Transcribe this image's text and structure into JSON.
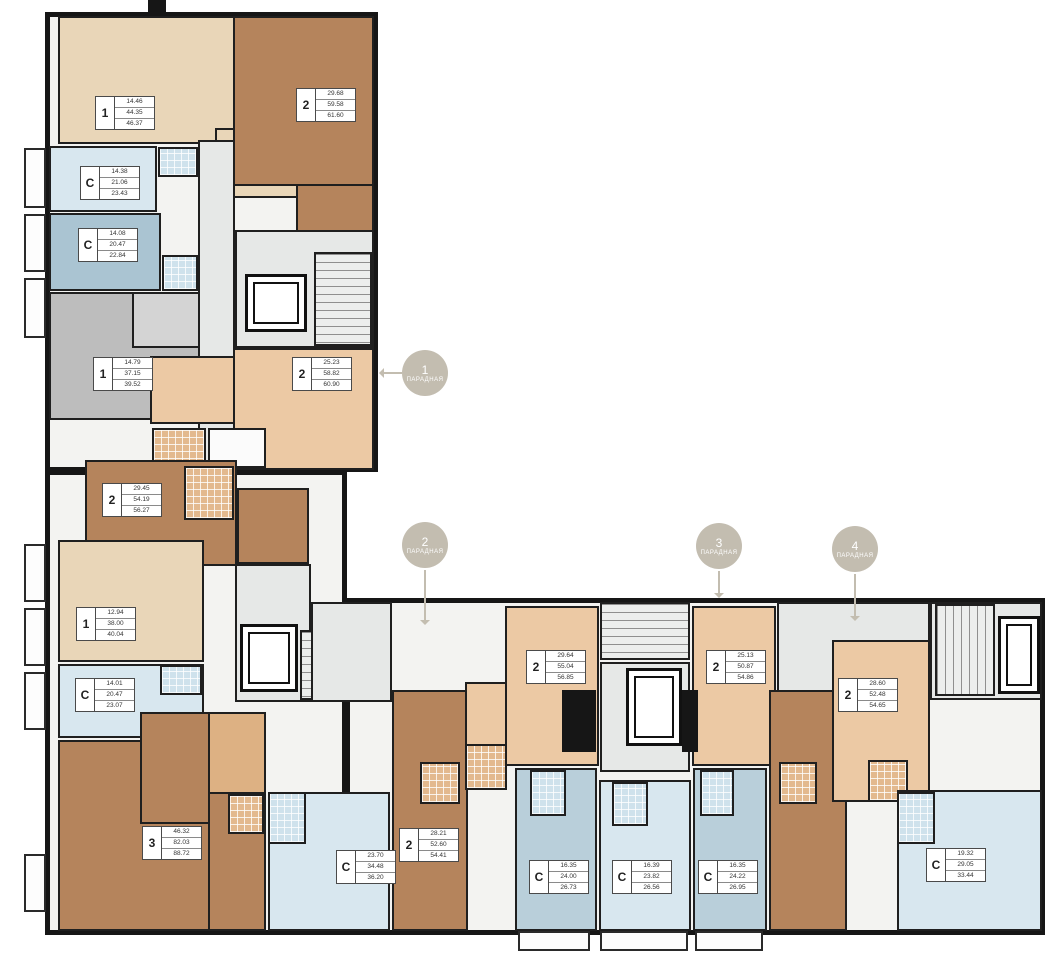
{
  "plan_title": "floor-plan",
  "entrances": [
    {
      "number": "1",
      "label": "ПАРАДНАЯ"
    },
    {
      "number": "2",
      "label": "ПАРАДНАЯ"
    },
    {
      "number": "3",
      "label": "ПАРАДНАЯ"
    },
    {
      "number": "4",
      "label": "ПАРАДНАЯ"
    }
  ],
  "units": [
    {
      "type": "1",
      "areas": [
        "14.46",
        "44.35",
        "46.37"
      ]
    },
    {
      "type": "2",
      "areas": [
        "29.68",
        "59.58",
        "61.60"
      ]
    },
    {
      "type": "С",
      "areas": [
        "14.38",
        "21.06",
        "23.43"
      ]
    },
    {
      "type": "С",
      "areas": [
        "14.08",
        "20.47",
        "22.84"
      ]
    },
    {
      "type": "1",
      "areas": [
        "14.79",
        "37.15",
        "39.52"
      ]
    },
    {
      "type": "2",
      "areas": [
        "25.23",
        "58.82",
        "60.90"
      ]
    },
    {
      "type": "2",
      "areas": [
        "29.45",
        "54.19",
        "56.27"
      ]
    },
    {
      "type": "1",
      "areas": [
        "12.94",
        "38.00",
        "40.04"
      ]
    },
    {
      "type": "С",
      "areas": [
        "14.01",
        "20.47",
        "23.07"
      ]
    },
    {
      "type": "3",
      "areas": [
        "46.32",
        "82.03",
        "88.72"
      ]
    },
    {
      "type": "С",
      "areas": [
        "23.70",
        "34.48",
        "36.20"
      ]
    },
    {
      "type": "2",
      "areas": [
        "28.21",
        "52.60",
        "54.41"
      ]
    },
    {
      "type": "2",
      "areas": [
        "29.64",
        "55.04",
        "56.85"
      ]
    },
    {
      "type": "2",
      "areas": [
        "25.13",
        "50.87",
        "54.86"
      ]
    },
    {
      "type": "2",
      "areas": [
        "28.60",
        "52.48",
        "54.65"
      ]
    },
    {
      "type": "С",
      "areas": [
        "16.35",
        "24.00",
        "26.73"
      ]
    },
    {
      "type": "С",
      "areas": [
        "16.39",
        "23.82",
        "26.56"
      ]
    },
    {
      "type": "С",
      "areas": [
        "16.35",
        "24.22",
        "26.95"
      ]
    },
    {
      "type": "С",
      "areas": [
        "19.32",
        "29.05",
        "33.44"
      ]
    }
  ],
  "colors": {
    "wall": "#161616",
    "one_room_tan": "#e9d6b8",
    "two_room_tan": "#ecc9a4",
    "two_room_brown": "#b5845c",
    "one_room_gray": "#bdbdbd",
    "studio_blue_light": "#d8e7ef",
    "studio_blue_gray": "#aac4d2",
    "corridor_gray": "#e6e8e7",
    "entrance_badge": "#c3bdb0"
  }
}
